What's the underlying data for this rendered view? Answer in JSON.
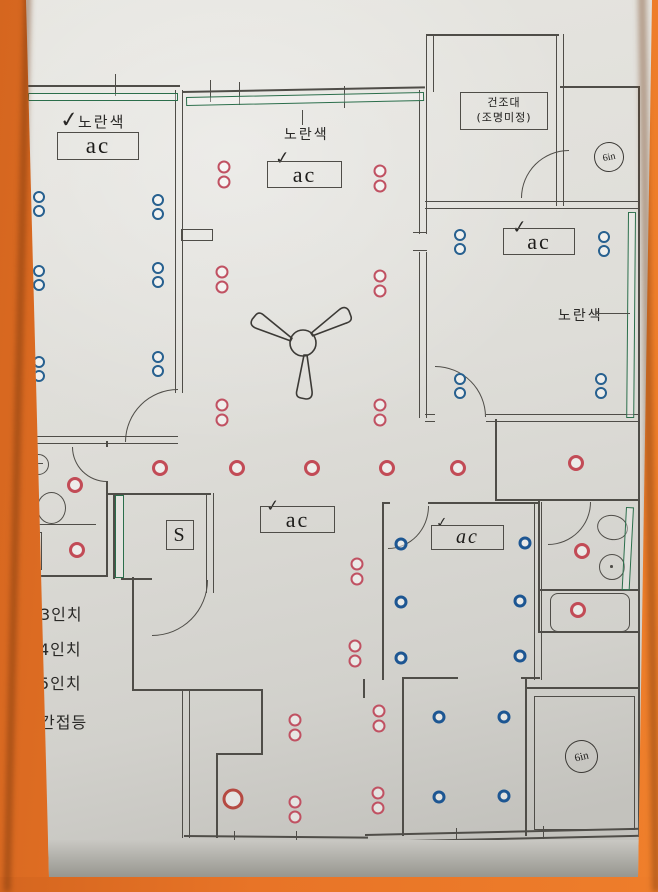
{
  "labels": {
    "yellow_note": "노란색",
    "ac": "ac",
    "check": "✓",
    "dry_rack_line1": "건조대",
    "dry_rack_line2": "(조명미정)",
    "six_inch": "6in",
    "switch": "S"
  },
  "legend": {
    "items": [
      {
        "label": "3인치",
        "color": "#27608f"
      },
      {
        "label": "4인치",
        "color": "#c05162"
      },
      {
        "label": "5인치",
        "color": "#c24b56"
      },
      {
        "label": "간접등",
        "color": "#2b6e4b"
      }
    ]
  },
  "plan": {
    "colors": {
      "orange_background": "#e87427",
      "paper": "#deddd8",
      "wall": "#4f4d48",
      "blue_3in": "#27608f",
      "red_4in": "#c05162",
      "red_5in": "#c24b56",
      "green_indirect": "#2b6e4b"
    },
    "blue_pairs": [
      [
        39,
        197
      ],
      [
        158,
        200
      ],
      [
        39,
        271
      ],
      [
        158,
        268
      ],
      [
        39,
        362
      ],
      [
        158,
        357
      ],
      [
        460,
        235
      ],
      [
        604,
        237
      ],
      [
        460,
        379
      ],
      [
        601,
        379
      ]
    ],
    "red_pairs": [
      [
        224,
        167
      ],
      [
        380,
        171
      ],
      [
        222,
        272
      ],
      [
        380,
        276
      ],
      [
        222,
        405
      ],
      [
        380,
        405
      ],
      [
        357,
        564
      ],
      [
        355,
        646
      ],
      [
        295,
        720
      ],
      [
        379,
        711
      ],
      [
        295,
        802
      ],
      [
        378,
        793
      ]
    ],
    "red_singles": [
      [
        160,
        468
      ],
      [
        237,
        468
      ],
      [
        312,
        468
      ],
      [
        387,
        468
      ],
      [
        458,
        468
      ],
      [
        576,
        463
      ],
      [
        75,
        485
      ],
      [
        77,
        550
      ],
      [
        582,
        551
      ],
      [
        578,
        610
      ]
    ],
    "red_large": [
      [
        233,
        799
      ]
    ],
    "blue_singles": [
      [
        401,
        544
      ],
      [
        525,
        543
      ],
      [
        401,
        602
      ],
      [
        520,
        601
      ],
      [
        401,
        658
      ],
      [
        520,
        656
      ],
      [
        439,
        717
      ],
      [
        504,
        717
      ],
      [
        439,
        797
      ],
      [
        504,
        796
      ]
    ],
    "green_bars": [
      [
        28,
        93,
        150,
        8,
        0
      ],
      [
        186,
        97,
        238,
        9,
        -1.2
      ],
      [
        628,
        212,
        8,
        206,
        0.5
      ],
      [
        20,
        442,
        8,
        86,
        0
      ],
      [
        115,
        495,
        9,
        83,
        0
      ],
      [
        626,
        507,
        8,
        83,
        3
      ]
    ]
  }
}
